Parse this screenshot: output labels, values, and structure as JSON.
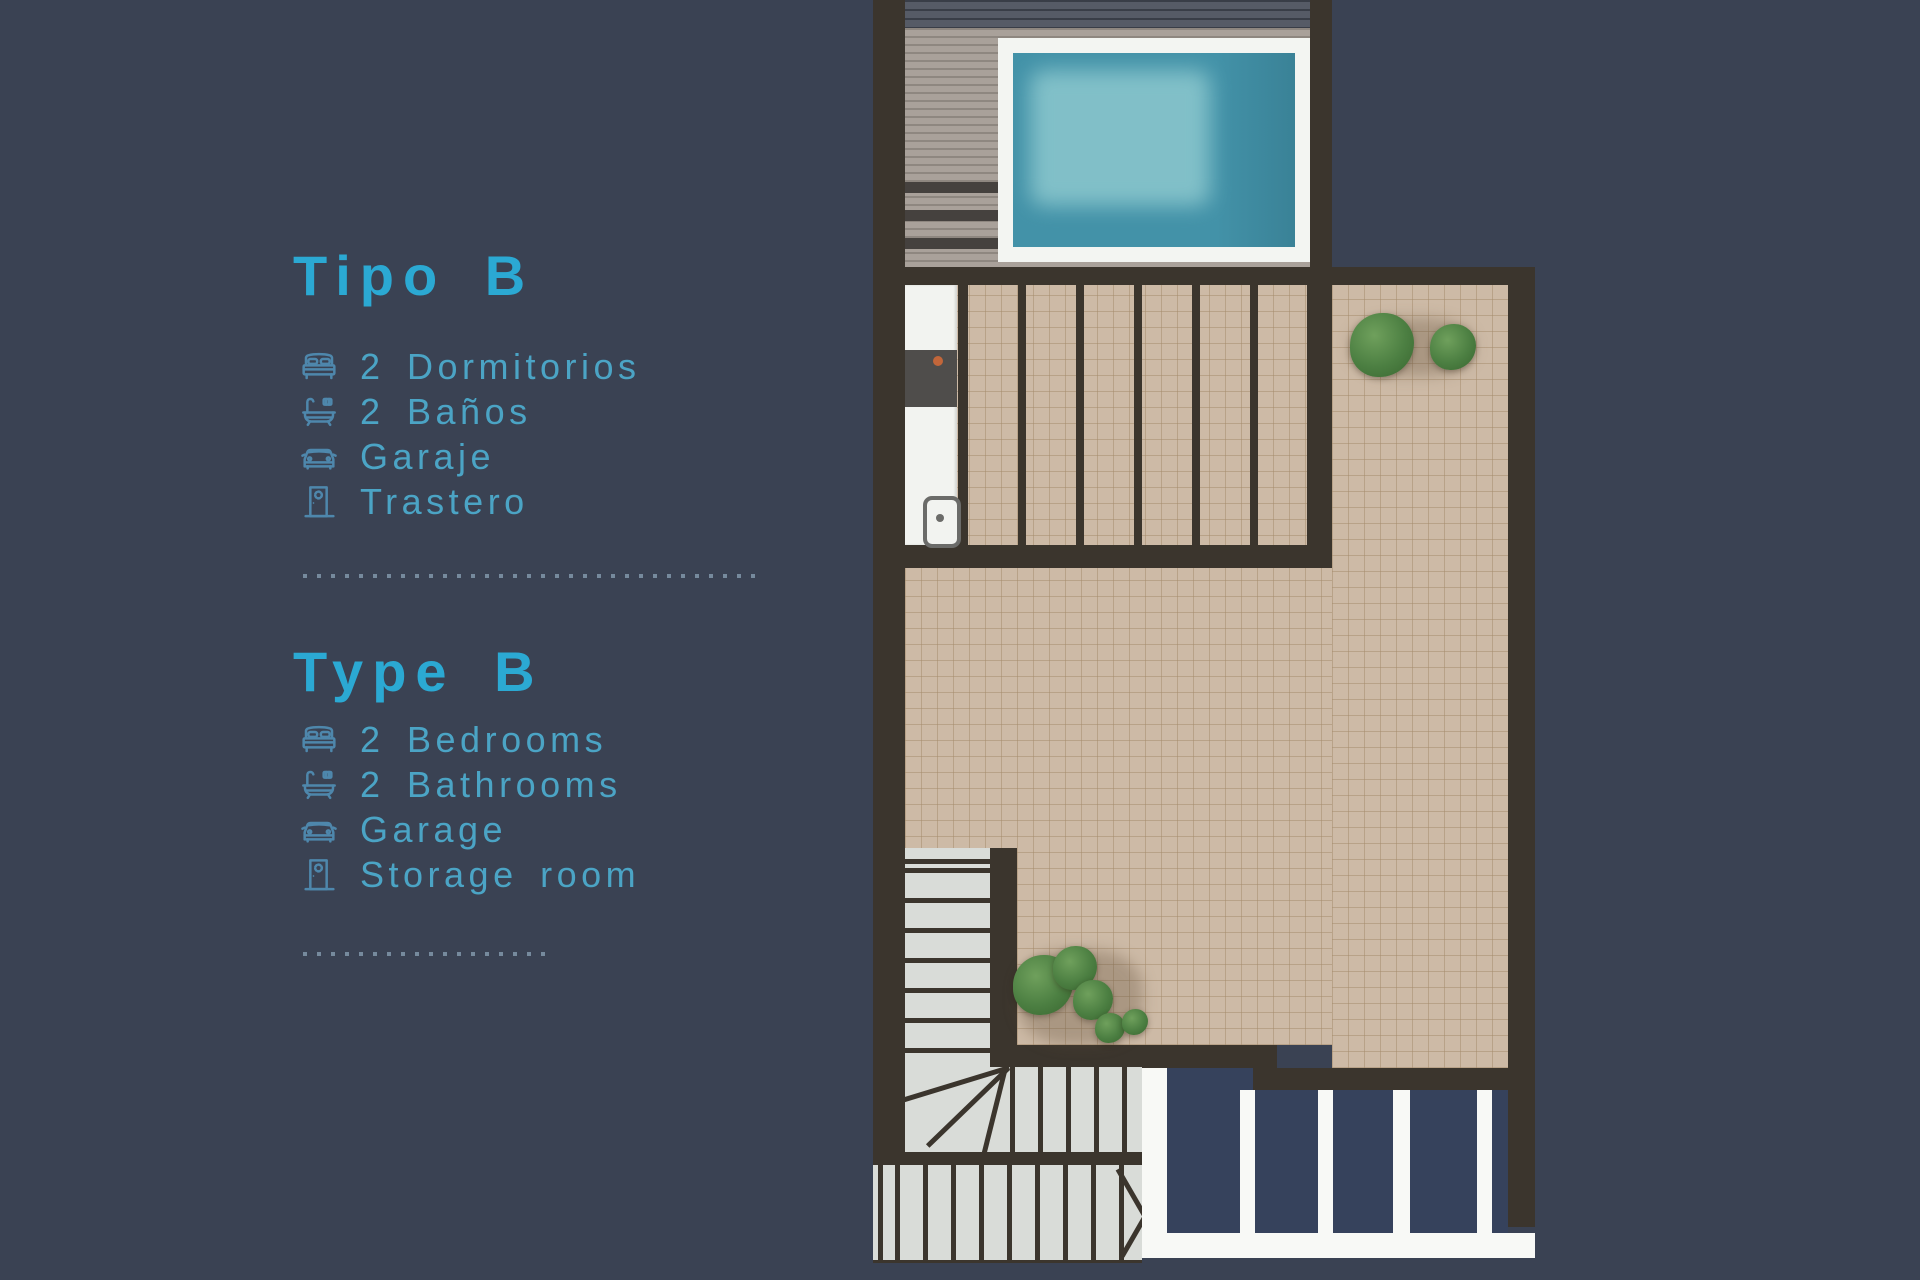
{
  "sections": [
    {
      "heading": "Tipo B",
      "items": [
        {
          "icon": "bed-icon",
          "label": "2 Dormitorios"
        },
        {
          "icon": "bath-icon",
          "label": "2 Baños"
        },
        {
          "icon": "car-icon",
          "label": "Garaje"
        },
        {
          "icon": "door-icon",
          "label": "Trastero"
        }
      ]
    },
    {
      "heading": "Type B",
      "items": [
        {
          "icon": "bed-icon",
          "label": "2 Bedrooms"
        },
        {
          "icon": "bath-icon",
          "label": "2 Bathrooms"
        },
        {
          "icon": "car-icon",
          "label": "Garage"
        },
        {
          "icon": "door-icon",
          "label": "Storage room"
        }
      ]
    }
  ],
  "palette": {
    "bg": "#3A4253",
    "heading_text": "#2BA9D3",
    "item_text": "#4BA4C5",
    "icon": "#4E87AC",
    "dots": "#8AA2B6",
    "wall": "#3B352D",
    "tile": "#CDBAA6",
    "tile_line": "rgba(164,138,106,0.5)",
    "deck": "#A9A19A",
    "deck_stripe": "#45413E",
    "roof_band": "#565B66",
    "pool_border": "#F3F5F2",
    "pool_water": "#4392A8",
    "pool_light": "#8CC8CE",
    "stair": "#D9DCD8",
    "white": "#F8F9F6",
    "lower_roof": "#36425C",
    "plant": "#4C7F42",
    "counter": "#F2F3F0",
    "grill": "#4F4D4B",
    "grill_knob": "#C2663A"
  }
}
